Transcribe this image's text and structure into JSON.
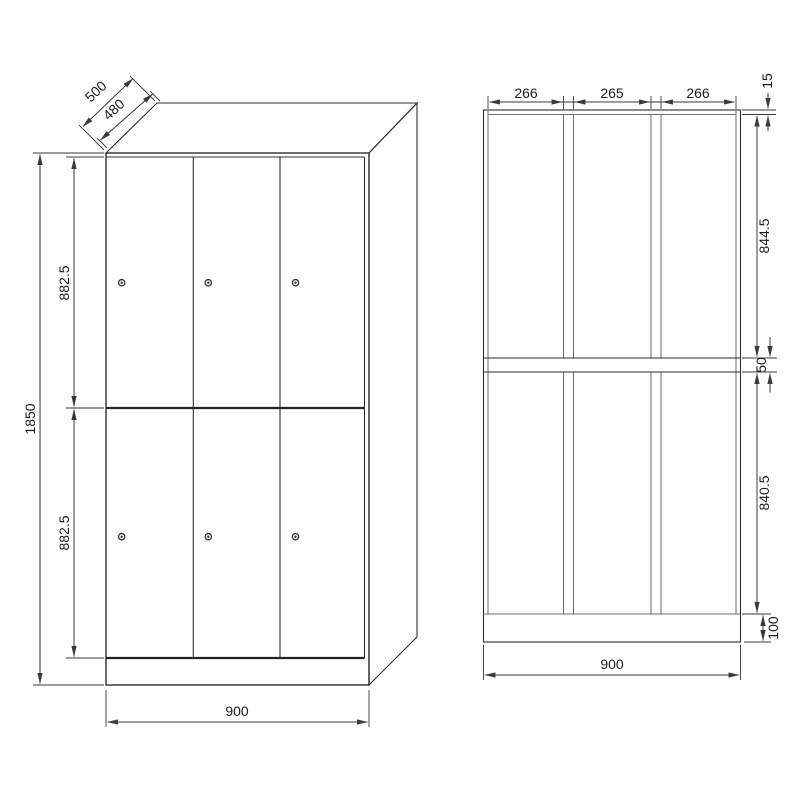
{
  "front_view": {
    "depth": "500",
    "depth_inner": "480",
    "total_height": "1850",
    "upper_door_height": "882.5",
    "lower_door_height": "882.5",
    "width": "900"
  },
  "section_view": {
    "left_compartment_width": "266",
    "middle_compartment_width": "265",
    "right_compartment_width": "266",
    "top_panel_thickness": "15",
    "upper_compartment_height": "844.5",
    "shelf_thickness": "50",
    "lower_compartment_height": "840.5",
    "plinth_height": "100",
    "width": "900"
  },
  "colors": {
    "ink": "#2e2e2e",
    "panel_line": "#6e6e6e",
    "dimension_line": "#3a3a3a",
    "text": "#1b1b1b",
    "background": "#ffffff"
  }
}
